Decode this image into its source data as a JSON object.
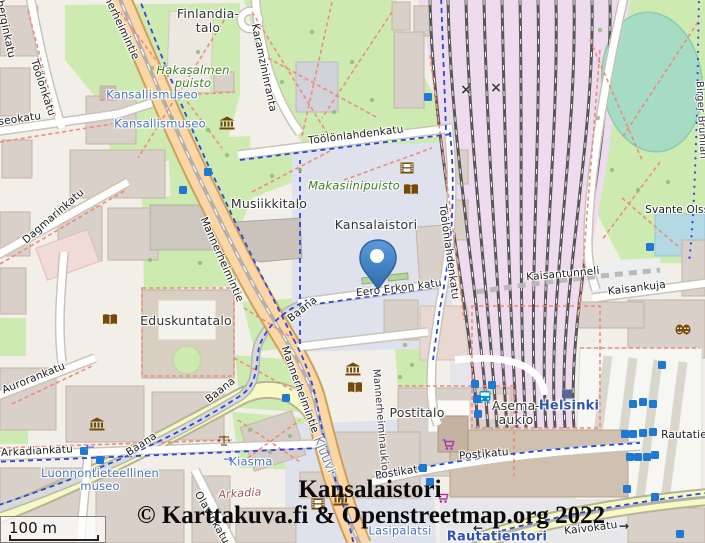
{
  "overlay": {
    "title": "Kansalaistori",
    "attribution": "© Karttakuva.fi & Openstreetmap.org 2022",
    "scale_label": "100 m"
  },
  "colors": {
    "land": "#f1efe8",
    "park": "#cdebb0",
    "building": "#d9d0c9",
    "plaza": "#dfe2ec",
    "railway_yard": "#eedcee",
    "rail": "#575757",
    "primary_road": "#fcd6a4",
    "secondary_road": "#f6f9c4",
    "cycle_route_blue": "#2946dd",
    "path_red": "#ee8a7a",
    "marker_blue": "#3d80ca",
    "poi_label_blue": "#4a74b8",
    "station_blue": "#3353b0",
    "park_label_green": "#3e7d22",
    "amenity_brown": "#734a08",
    "shop_purple": "#ac39ac",
    "transit_blue": "#0092da",
    "elevator_blue": "#1f78d1"
  },
  "map": {
    "labels": [
      {
        "id": "finlandia-talo",
        "text": "Finlandia-\ntalo",
        "cls": "place",
        "x": 208,
        "y": 21,
        "rot": 0
      },
      {
        "id": "hakasalmen-puisto",
        "text": "Hakasalmen\npuisto",
        "cls": "park-lbl",
        "x": 193,
        "y": 77,
        "rot": 0
      },
      {
        "id": "kansallismuseo-1",
        "text": "Kansallismuseo",
        "cls": "poi",
        "x": 152,
        "y": 95,
        "rot": 0
      },
      {
        "id": "kansallismuseo-2",
        "text": "Kansallismuseo",
        "cls": "poi",
        "x": 160,
        "y": 124,
        "rot": 0
      },
      {
        "id": "toolonkatu",
        "text": "Töölönkatu",
        "cls": "street",
        "x": 42,
        "y": 88,
        "rot": 72
      },
      {
        "id": "runeberginkatu",
        "text": "Runeberginkatu",
        "cls": "street",
        "x": 2,
        "y": 16,
        "rot": 78
      },
      {
        "id": "museokatu",
        "text": "Museokatu",
        "cls": "street",
        "x": 12,
        "y": 121,
        "rot": -8
      },
      {
        "id": "karamzininranta",
        "text": "Karamzininranta",
        "cls": "street",
        "x": 263,
        "y": 68,
        "rot": 78
      },
      {
        "id": "mannerheimintie-top",
        "text": "Mannerheimintie",
        "cls": "street",
        "x": 116,
        "y": 18,
        "rot": 65
      },
      {
        "id": "mannerheimintie-mid",
        "text": "Mannerheimintie",
        "cls": "street",
        "x": 221,
        "y": 260,
        "rot": 66
      },
      {
        "id": "mannerheimintie-low",
        "text": "Mannerheimintie",
        "cls": "street",
        "x": 299,
        "y": 390,
        "rot": 70
      },
      {
        "id": "dagmarinkatu",
        "text": "Dagmarinkatu",
        "cls": "street",
        "x": 54,
        "y": 217,
        "rot": -41
      },
      {
        "id": "toolonlahdenkatu-h",
        "text": "Töölönlahdenkatu",
        "cls": "street",
        "x": 356,
        "y": 136,
        "rot": -7
      },
      {
        "id": "toolonlahdenkatu-v",
        "text": "Töölönlahdenkatu",
        "cls": "street",
        "x": 448,
        "y": 252,
        "rot": 82
      },
      {
        "id": "makasiinipuisto",
        "text": "Makasiinipuisto",
        "cls": "park-lbl",
        "x": 354,
        "y": 186,
        "rot": 0
      },
      {
        "id": "musiikkitalo",
        "text": "Musiikkitalo",
        "cls": "place",
        "x": 269,
        "y": 204,
        "rot": 0
      },
      {
        "id": "kansalaistori",
        "text": "Kansalaistori",
        "cls": "place",
        "x": 376,
        "y": 225,
        "rot": 0
      },
      {
        "id": "eero-erkon-katu",
        "text": "Eero Erkon katu",
        "cls": "street",
        "x": 399,
        "y": 289,
        "rot": -7
      },
      {
        "id": "eduskuntatalo",
        "text": "Eduskuntatalo",
        "cls": "place",
        "x": 186,
        "y": 321,
        "rot": 0
      },
      {
        "id": "baana-1",
        "text": "Baana",
        "cls": "street",
        "x": 303,
        "y": 310,
        "rot": -38
      },
      {
        "id": "baana-2",
        "text": "Baana",
        "cls": "street",
        "x": 221,
        "y": 391,
        "rot": -38
      },
      {
        "id": "baana-3",
        "text": "Baana",
        "cls": "street",
        "x": 142,
        "y": 445,
        "rot": -33
      },
      {
        "id": "aurorankatu",
        "text": "Aurorankatu",
        "cls": "street",
        "x": 34,
        "y": 379,
        "rot": -22
      },
      {
        "id": "arkadiankatu",
        "text": "Arkadiankatu",
        "cls": "street",
        "x": 37,
        "y": 452,
        "rot": -3
      },
      {
        "id": "luonnontieteellinen-museo",
        "text": "Luonnontieteellinen\nmuseo",
        "cls": "poi",
        "x": 100,
        "y": 480,
        "rot": 0
      },
      {
        "id": "kiasma",
        "text": "Kiasma",
        "cls": "poi",
        "x": 251,
        "y": 462,
        "rot": 0
      },
      {
        "id": "arkadia",
        "text": "Arkadia",
        "cls": "retail",
        "x": 240,
        "y": 494,
        "rot": -4
      },
      {
        "id": "olavinkatu",
        "text": "Olavinkatu",
        "cls": "street",
        "x": 211,
        "y": 518,
        "rot": 60
      },
      {
        "id": "kluuvi",
        "text": "Kluuvi",
        "cls": "district",
        "x": 324,
        "y": 455,
        "rot": 68
      },
      {
        "id": "mannerheiminaukio",
        "text": "Mannerheiminaukio",
        "cls": "street-sm",
        "x": 380,
        "y": 420,
        "rot": 85
      },
      {
        "id": "postitalo",
        "text": "Postitalo",
        "cls": "place",
        "x": 417,
        "y": 413,
        "rot": 0
      },
      {
        "id": "postikatu-1",
        "text": "Postikatu",
        "cls": "street",
        "x": 400,
        "y": 473,
        "rot": -9
      },
      {
        "id": "postikatu-2",
        "text": "Postikatu",
        "cls": "street",
        "x": 484,
        "y": 455,
        "rot": -5
      },
      {
        "id": "asema-aukio",
        "text": "Asema-\naukio",
        "cls": "place",
        "x": 516,
        "y": 413,
        "rot": 0
      },
      {
        "id": "helsinki",
        "text": "Helsinki",
        "cls": "station",
        "x": 569,
        "y": 407,
        "rot": 0
      },
      {
        "id": "kaisantunneli",
        "text": "Kaisantunneli",
        "cls": "street",
        "x": 563,
        "y": 275,
        "rot": -5
      },
      {
        "id": "kaisankuja",
        "text": "Kaisankuja",
        "cls": "street",
        "x": 637,
        "y": 289,
        "rot": -7
      },
      {
        "id": "svante-olssonin",
        "text": "Svante Olssonin",
        "cls": "street",
        "x": 689,
        "y": 211,
        "rot": 0
      },
      {
        "id": "birger-brunilan",
        "text": "Birger Brunilan",
        "cls": "street-sm",
        "x": 701,
        "y": 120,
        "rot": 87
      },
      {
        "id": "rautatieasema",
        "text": "Rautatieasema",
        "cls": "street",
        "x": 702,
        "y": 436,
        "rot": 0
      },
      {
        "id": "kaivokatu",
        "text": "Kaivokatu",
        "cls": "street",
        "x": 591,
        "y": 529,
        "rot": -7
      },
      {
        "id": "lasipalatsi",
        "text": "Lasipalatsi",
        "cls": "poi",
        "x": 400,
        "y": 531,
        "rot": 0
      },
      {
        "id": "rautatientori",
        "text": "Rautatientori",
        "cls": "station",
        "x": 497,
        "y": 538,
        "rot": 0
      }
    ],
    "icons": [
      {
        "t": "museum",
        "x": 227,
        "y": 124
      },
      {
        "t": "museum",
        "x": 97,
        "y": 425
      },
      {
        "t": "museum",
        "x": 353,
        "y": 370
      },
      {
        "t": "museum",
        "x": 341,
        "y": 500
      },
      {
        "t": "book",
        "x": 110,
        "y": 320
      },
      {
        "t": "book",
        "x": 355,
        "y": 388
      },
      {
        "t": "book",
        "x": 411,
        "y": 190
      },
      {
        "t": "film",
        "x": 407,
        "y": 168
      },
      {
        "t": "film",
        "x": 318,
        "y": 504
      },
      {
        "t": "masks",
        "x": 683,
        "y": 330
      },
      {
        "t": "scales",
        "x": 224,
        "y": 441
      },
      {
        "t": "cart",
        "x": 448,
        "y": 445
      },
      {
        "t": "cart",
        "x": 442,
        "y": 498
      },
      {
        "t": "bus",
        "x": 485,
        "y": 398
      },
      {
        "t": "station-square",
        "x": 567,
        "y": 393
      }
    ],
    "elevator_squares": [
      [
        428,
        97
      ],
      [
        208,
        172
      ],
      [
        183,
        190
      ],
      [
        650,
        247
      ],
      [
        286,
        398
      ],
      [
        84,
        451
      ],
      [
        100,
        460
      ],
      [
        423,
        468
      ],
      [
        430,
        482
      ],
      [
        475,
        384
      ],
      [
        492,
        385
      ],
      [
        477,
        399
      ],
      [
        478,
        414
      ],
      [
        633,
        404
      ],
      [
        643,
        402
      ],
      [
        653,
        404
      ],
      [
        625,
        434
      ],
      [
        633,
        434
      ],
      [
        643,
        433
      ],
      [
        653,
        432
      ],
      [
        630,
        457
      ],
      [
        638,
        457
      ],
      [
        647,
        457
      ],
      [
        655,
        455
      ],
      [
        627,
        489
      ],
      [
        655,
        497
      ],
      [
        662,
        365
      ],
      [
        680,
        534
      ]
    ],
    "marks": [
      {
        "glyph": "×",
        "cls": "crossing",
        "x": 466,
        "y": 90
      },
      {
        "glyph": "×",
        "cls": "crossing",
        "x": 496,
        "y": 88
      },
      {
        "glyph": "←",
        "cls": "arrow-blue",
        "x": 90,
        "y": 447
      },
      {
        "glyph": "→",
        "cls": "arrow-blue",
        "x": 228,
        "y": 459
      },
      {
        "glyph": "→",
        "cls": "arrow-dark",
        "x": 624,
        "y": 526
      },
      {
        "glyph": "←",
        "cls": "arrow-dark",
        "x": 478,
        "y": 528
      }
    ],
    "marker": {
      "name": "kansalaistori-marker",
      "tip_x": 378,
      "tip_y": 289
    }
  }
}
